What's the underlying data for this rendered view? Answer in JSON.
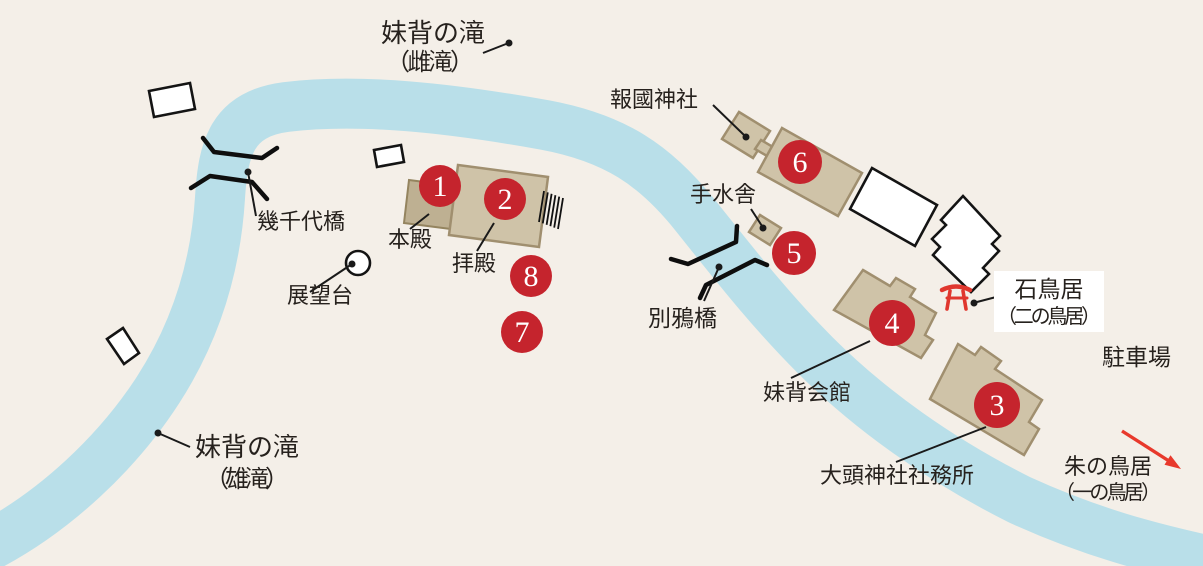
{
  "colors": {
    "background": "#f4efe8",
    "river": "#b9dfe9",
    "building_fill": "#cfc3a8",
    "building_fill_dark": "#beb092",
    "marker_red": "#c5242d",
    "torii_red": "#e0372e",
    "arrow_red": "#e8392c",
    "text": "#26211d"
  },
  "markers": [
    {
      "number": "1"
    },
    {
      "number": "2"
    },
    {
      "number": "3"
    },
    {
      "number": "4"
    },
    {
      "number": "5"
    },
    {
      "number": "6"
    },
    {
      "number": "7"
    },
    {
      "number": "8"
    }
  ],
  "labels": {
    "female_falls_line1": "妹背の滝",
    "female_falls_line2": "（雌滝）",
    "male_falls_line1": "妹背の滝",
    "male_falls_line2": "（雄滝）",
    "ikuchiyo_bridge": "幾千代橋",
    "observation_deck": "展望台",
    "main_hall": "本殿",
    "worship_hall": "拝殿",
    "hokoku_shrine": "報國神社",
    "chozuya": "手水舎",
    "bekka_bridge": "別鴉橋",
    "imose_hall": "妹背会館",
    "stone_torii_line1": "石鳥居",
    "stone_torii_line2": "（二の鳥居）",
    "parking": "駐車場",
    "shrine_office": "大頭神社社務所",
    "vermilion_torii_line1": "朱の鳥居",
    "vermilion_torii_line2": "（一の鳥居）"
  }
}
